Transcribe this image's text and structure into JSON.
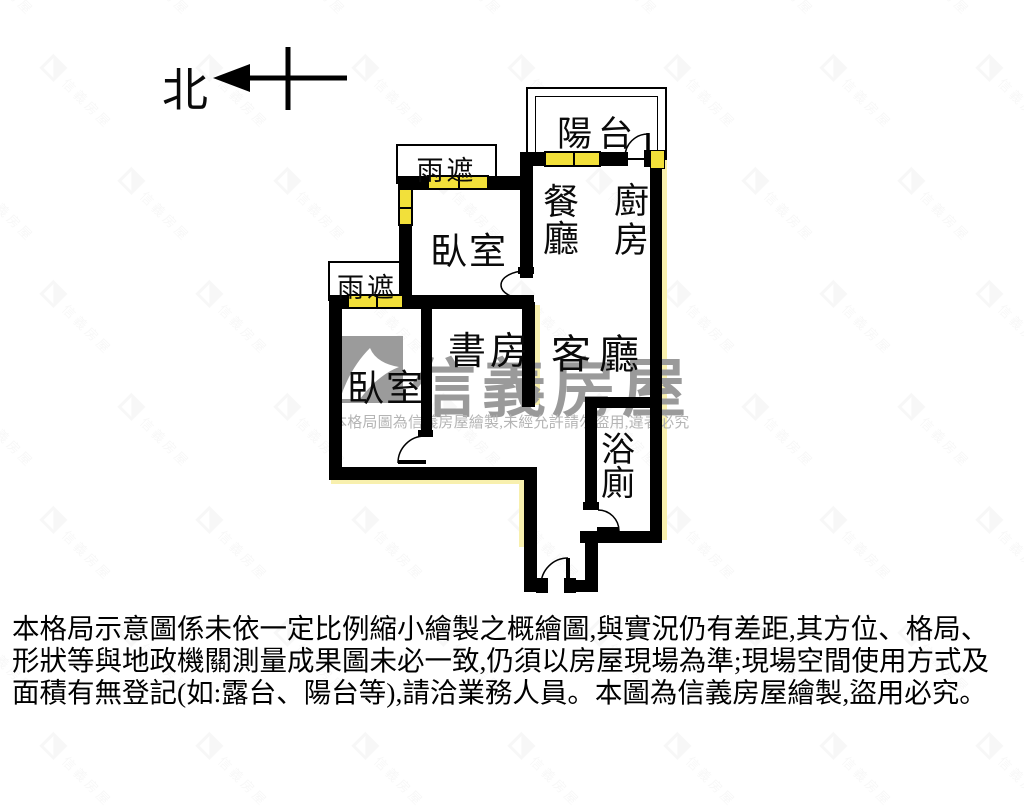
{
  "compass": {
    "north_label": "北"
  },
  "rooms": {
    "balcony": "陽台",
    "kitchen": "廚房",
    "dining": "餐廳",
    "bedroom1": "臥室",
    "bedroom2": "臥室",
    "study": "書房",
    "living": "客廳",
    "bathroom": "浴廁",
    "canopy1": "雨遮",
    "canopy2": "雨遮"
  },
  "watermark": {
    "brand": "信義房屋",
    "notice": "本格局圖為信義房屋繪製,未經允許請勿盜用,違者必究",
    "tile_text": "信義房屋"
  },
  "disclaimer": {
    "line1": "本格局示意圖係未依一定比例縮小繪製之概繪圖,與實況仍有差距,其方位、格局、",
    "line2": "形狀等與地政機關測量成果圖未必一致,仍須以房屋現場為準;現場空間使用方式及",
    "line3": "面積有無登記(如:露台、陽台等),請洽業務人員。本圖為信義房屋繪製,盜用必究。"
  },
  "colors": {
    "wall": "#000000",
    "window_yellow": "#f2e03a",
    "edge_highlight": "#f8f0ae",
    "watermark_gray": "#9a9a9a"
  }
}
